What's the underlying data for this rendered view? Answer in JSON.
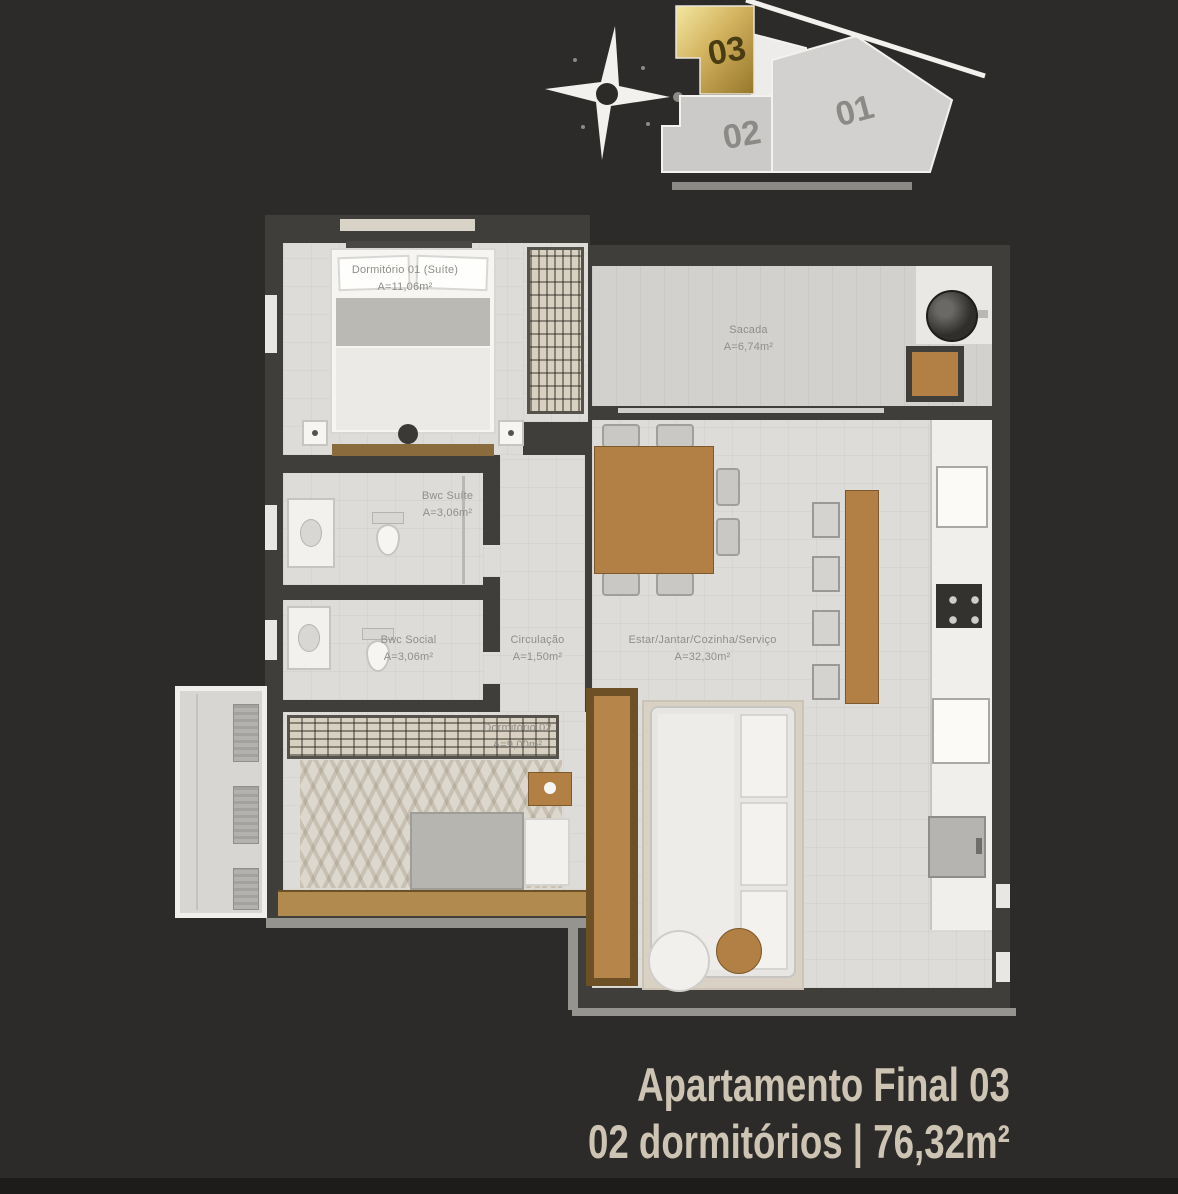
{
  "key": {
    "u01": "01",
    "u02": "02",
    "u03": "03"
  },
  "rooms": {
    "dorm01": {
      "name": "Dormitório 01 (Suíte)",
      "area": "A=11,06m²"
    },
    "bwc_suite": {
      "name": "Bwc Suíte",
      "area": "A=3,06m²"
    },
    "bwc_social": {
      "name": "Bwc Social",
      "area": "A=3,06m²"
    },
    "circulacao": {
      "name": "Circulação",
      "area": "A=1,50m²"
    },
    "estar": {
      "name": "Estar/Jantar/Cozinha/Serviço",
      "area": "A=32,30m²"
    },
    "sacada": {
      "name": "Sacada",
      "area": "A=6,74m²"
    },
    "dorm02": {
      "name": "Dormitório 02",
      "area": "A=9,00m²"
    }
  },
  "footer": {
    "line1": "Apartamento Final 03",
    "line2": "02 dormitórios | 76,32m²"
  },
  "colors": {
    "background": "#2c2b29",
    "accent_gold": "#c9a84c",
    "wall": "#403e3a",
    "floor": "#dedcd8",
    "label": "#8f8e8a",
    "title": "#cec4b4"
  }
}
